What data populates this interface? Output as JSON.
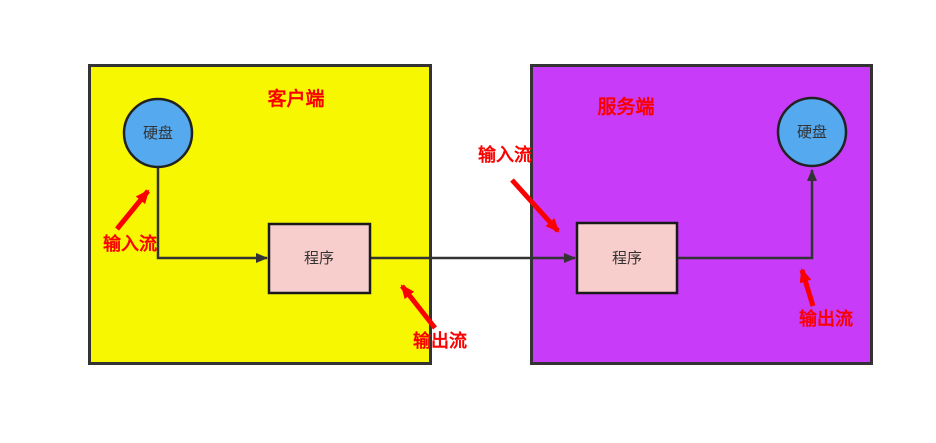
{
  "client": {
    "title": "客户端",
    "disk_label": "硬盘",
    "program_label": "程序",
    "input_stream_label": "输入流",
    "output_stream_label": "输出流"
  },
  "server": {
    "title": "服务端",
    "disk_label": "硬盘",
    "program_label": "程序",
    "input_stream_label": "输入流",
    "output_stream_label": "输出流"
  },
  "colors": {
    "client_bg": "#F7F702",
    "server_bg": "#C83BF8",
    "disk_fill": "#55A9EF",
    "program_fill": "#F8CECC",
    "annotation_red": "#FB0000",
    "connector": "#333333"
  }
}
